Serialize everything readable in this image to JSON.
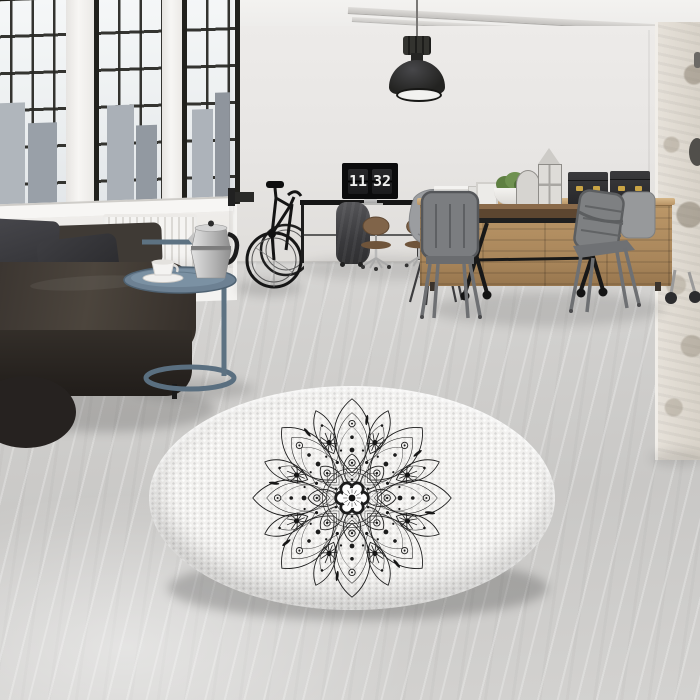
{
  "clock": {
    "hours": "11",
    "minutes": "32"
  },
  "palette": {
    "wall": "#e9e7e5",
    "floor": "#cfcecc",
    "window_frame": "#21211d",
    "glass": "#f0f2f3",
    "sofa_leather": "#3c3630",
    "pillow_charcoal": "#303033",
    "radiator_white": "#f2f1ef",
    "side_table_blue": "#5d7282",
    "moka_silver": "#c6c6c6",
    "pendant_black": "#262624",
    "monitor_black": "#0b0b0c",
    "clock_digit": "#efefed",
    "sideboard_wood": "#b08f63",
    "table_wood": "#6a4f37",
    "metal_chair_grey": "#7e8082",
    "storage_box_black": "#2f2f31",
    "box_brass": "#c9a445",
    "plant_green": "#5f7f41",
    "rug_base": "#f2f1ef",
    "mandala_ink": "#1c1c1c",
    "brick_column": "#ded8cf"
  }
}
